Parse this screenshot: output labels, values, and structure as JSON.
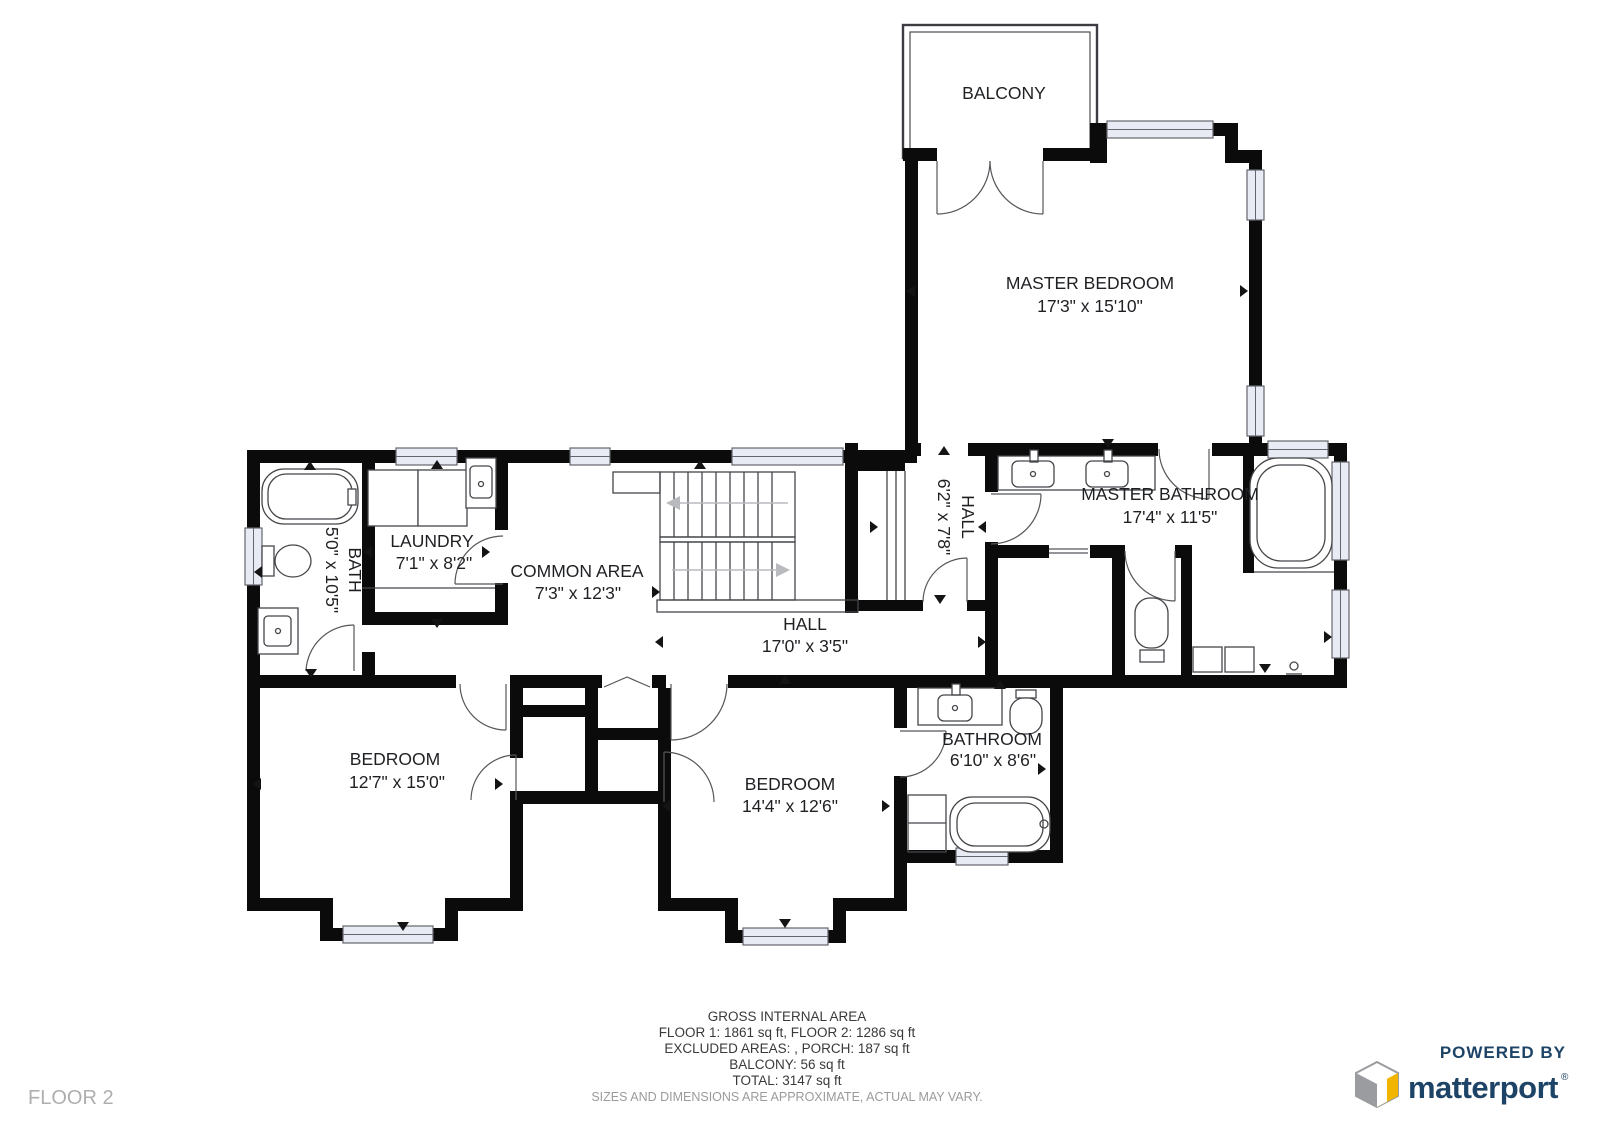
{
  "page": {
    "floor_label": "FLOOR 2"
  },
  "rooms": {
    "balcony": {
      "name": "BALCONY",
      "dims": ""
    },
    "master_bedroom": {
      "name": "MASTER BEDROOM",
      "dims": "17'3\" x 15'10\""
    },
    "master_bathroom": {
      "name": "MASTER BATHROOM",
      "dims": "17'4\" x 11'5\""
    },
    "hall_upper": {
      "name": "HALL",
      "dims": "6'2\" x 7'8\""
    },
    "laundry": {
      "name": "LAUNDRY",
      "dims": "7'1\" x 8'2\""
    },
    "common_area": {
      "name": "COMMON AREA",
      "dims": "7'3\" x 12'3\""
    },
    "bath": {
      "name": "BATH",
      "dims": "5'0\" x 10'5\""
    },
    "hall": {
      "name": "HALL",
      "dims": "17'0\" x 3'5\""
    },
    "bedroom_left": {
      "name": "BEDROOM",
      "dims": "12'7\" x 15'0\""
    },
    "bedroom_right": {
      "name": "BEDROOM",
      "dims": "14'4\" x 12'6\""
    },
    "bathroom": {
      "name": "BATHROOM",
      "dims": "6'10\" x 8'6\""
    }
  },
  "summary": {
    "line1": "GROSS INTERNAL AREA",
    "line2": "FLOOR 1: 1861 sq ft, FLOOR 2: 1286 sq ft",
    "line3": "EXCLUDED AREAS: , PORCH: 187 sq ft",
    "line4": "BALCONY: 56 sq ft",
    "line5": "TOTAL: 3147 sq ft",
    "disclaimer": "SIZES AND DIMENSIONS ARE APPROXIMATE, ACTUAL MAY VARY."
  },
  "branding": {
    "powered_by": "POWERED BY",
    "brand": "matterport",
    "registered": "®"
  },
  "colors": {
    "wall": "#0b0b0b",
    "window_fill": "#e9ebf4",
    "label_text": "#1f2023",
    "muted_text": "#9b9b9d",
    "brand_navy": "#1d4466",
    "brand_yellow": "#f1b500",
    "brand_gray": "#9a9ca0"
  }
}
